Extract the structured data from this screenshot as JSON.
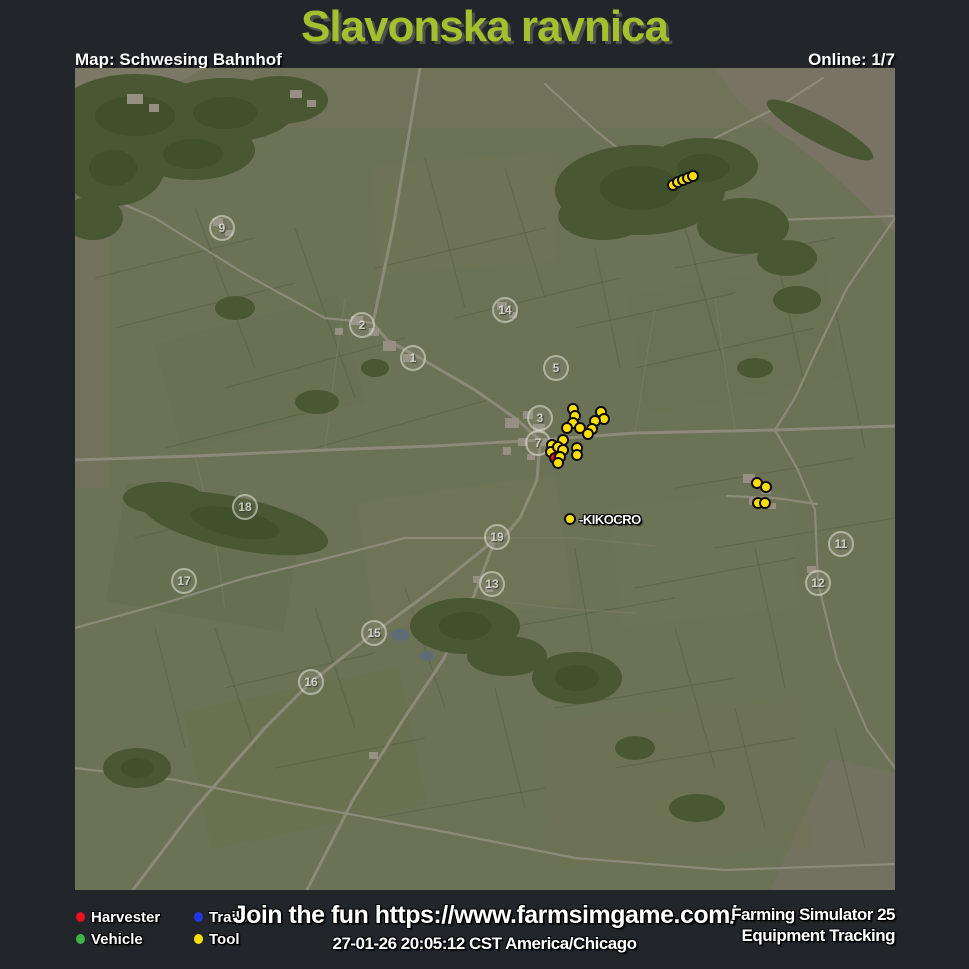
{
  "header": {
    "title": "Slavonska ravnica",
    "map_label": "Map: Schwesing Bahnhof",
    "online_label": "Online: 1/7"
  },
  "footer": {
    "legend": [
      {
        "label": "Harvester",
        "color": "#e81120"
      },
      {
        "label": "Vehicle",
        "color": "#3db548"
      },
      {
        "label": "Trailer",
        "color": "#2236e8"
      },
      {
        "label": "Tool",
        "color": "#ffe000"
      }
    ],
    "promo": "Join the fun https://www.farmsimgame.com/",
    "timestamp": "27-01-26 20:05:12 CST America/Chicago",
    "brand_line1": "Farming Simulator 25",
    "brand_line2": "Equipment Tracking"
  },
  "map": {
    "marker_colors": {
      "harvester": "#e81120",
      "vehicle": "#3db548",
      "trailer": "#2236e8",
      "tool": "#ffe000",
      "player": "#ffe000"
    },
    "field_numbers": [
      {
        "n": "9",
        "x": 147,
        "y": 160
      },
      {
        "n": "2",
        "x": 287,
        "y": 257
      },
      {
        "n": "1",
        "x": 338,
        "y": 290
      },
      {
        "n": "14",
        "x": 430,
        "y": 242
      },
      {
        "n": "5",
        "x": 481,
        "y": 300
      },
      {
        "n": "3",
        "x": 465,
        "y": 350
      },
      {
        "n": "7",
        "x": 463,
        "y": 375
      },
      {
        "n": "18",
        "x": 170,
        "y": 439
      },
      {
        "n": "19",
        "x": 422,
        "y": 469
      },
      {
        "n": "13",
        "x": 417,
        "y": 516
      },
      {
        "n": "17",
        "x": 109,
        "y": 513
      },
      {
        "n": "15",
        "x": 299,
        "y": 565
      },
      {
        "n": "16",
        "x": 236,
        "y": 614
      },
      {
        "n": "11",
        "x": 766,
        "y": 476
      },
      {
        "n": "12",
        "x": 743,
        "y": 515
      }
    ],
    "markers": [
      {
        "type": "tool",
        "x": 598,
        "y": 117
      },
      {
        "type": "tool",
        "x": 603,
        "y": 114
      },
      {
        "type": "tool",
        "x": 608,
        "y": 112
      },
      {
        "type": "tool",
        "x": 613,
        "y": 110
      },
      {
        "type": "tool",
        "x": 618,
        "y": 108
      },
      {
        "type": "tool",
        "x": 498,
        "y": 341
      },
      {
        "type": "tool",
        "x": 500,
        "y": 348
      },
      {
        "type": "tool",
        "x": 498,
        "y": 355
      },
      {
        "type": "tool",
        "x": 526,
        "y": 344
      },
      {
        "type": "tool",
        "x": 529,
        "y": 351
      },
      {
        "type": "tool",
        "x": 520,
        "y": 353
      },
      {
        "type": "tool",
        "x": 492,
        "y": 360
      },
      {
        "type": "tool",
        "x": 505,
        "y": 360
      },
      {
        "type": "tool",
        "x": 517,
        "y": 361
      },
      {
        "type": "tool",
        "x": 513,
        "y": 366
      },
      {
        "type": "tool",
        "x": 488,
        "y": 372
      },
      {
        "type": "tool",
        "x": 477,
        "y": 377
      },
      {
        "type": "tool",
        "x": 476,
        "y": 384
      },
      {
        "type": "tool",
        "x": 483,
        "y": 379
      },
      {
        "type": "tool",
        "x": 488,
        "y": 382
      },
      {
        "type": "tool",
        "x": 502,
        "y": 380
      },
      {
        "type": "tool",
        "x": 502,
        "y": 387
      },
      {
        "type": "harvester",
        "x": 480,
        "y": 390
      },
      {
        "type": "tool",
        "x": 485,
        "y": 389
      },
      {
        "type": "tool",
        "x": 483,
        "y": 395
      },
      {
        "type": "tool",
        "x": 682,
        "y": 415
      },
      {
        "type": "tool",
        "x": 691,
        "y": 419
      },
      {
        "type": "tool",
        "x": 683,
        "y": 435
      },
      {
        "type": "tool",
        "x": 690,
        "y": 435
      },
      {
        "type": "player",
        "x": 495,
        "y": 451,
        "label": "-KIKOCRO"
      }
    ]
  }
}
